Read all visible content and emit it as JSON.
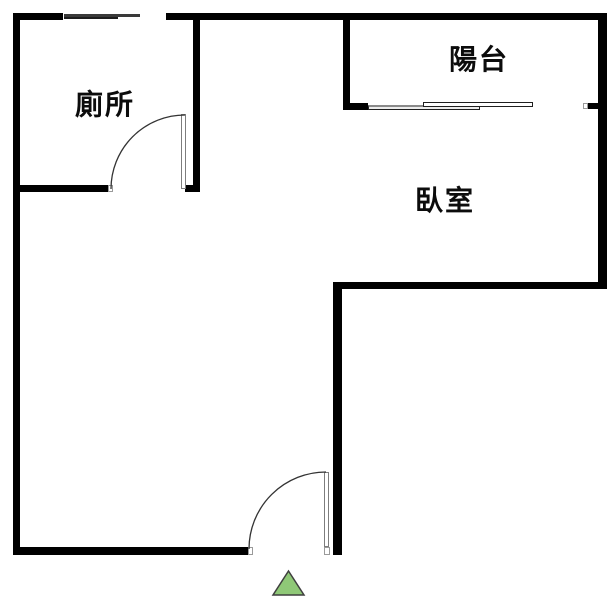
{
  "plan": {
    "rooms": [
      {
        "id": "toilet",
        "label": "廁所"
      },
      {
        "id": "balcony",
        "label": "陽台"
      },
      {
        "id": "bedroom",
        "label": "臥室"
      }
    ],
    "colors": {
      "wall": "#000000",
      "door_arc": "#333333",
      "door_leaf_border": "#7d7d7d",
      "window_pane_dark": "#1d1d1d",
      "window_pane_gray": "#3a3a3a",
      "entrance_triangle_fill": "#8fc877",
      "entrance_triangle_stroke": "#3f3f3f"
    }
  }
}
